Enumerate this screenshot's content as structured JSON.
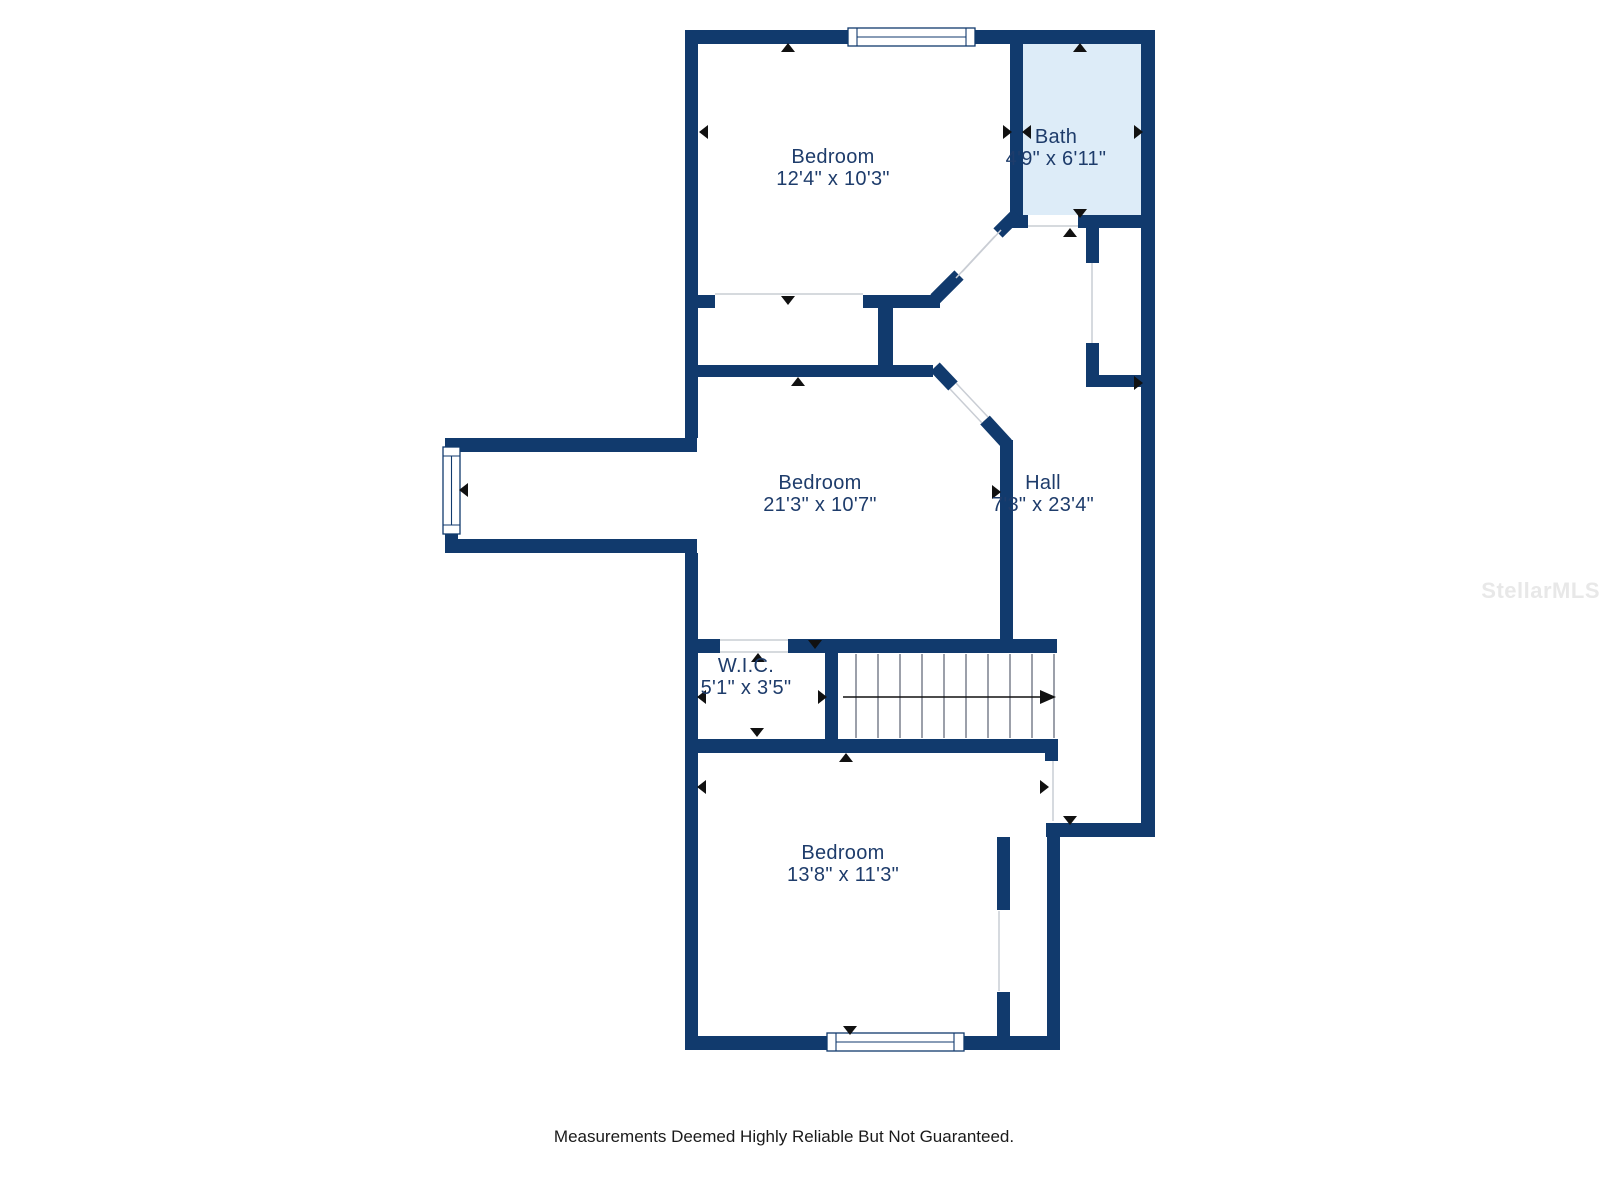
{
  "colors": {
    "background": "#ffffff",
    "wall": "#113a6d",
    "bath_fill": "#ddecf8",
    "label": "#1e3c6b",
    "opening_line": "#c9cdd4",
    "tread_line": "#5a6170",
    "arrow": "#111111",
    "footer_text": "#1a1a1a",
    "watermark": "#e8e8e8"
  },
  "rooms": [
    {
      "id": "bedroom-top",
      "name": "Bedroom",
      "dims": "12'4\" x 10'3\""
    },
    {
      "id": "bath",
      "name": "Bath",
      "dims": "4'9\" x 6'11\""
    },
    {
      "id": "bedroom-middle",
      "name": "Bedroom",
      "dims": "21'3\" x 10'7\""
    },
    {
      "id": "hall",
      "name": "Hall",
      "dims": "7'3\" x 23'4\""
    },
    {
      "id": "wic",
      "name": "W.I.C.",
      "dims": "5'1\" x 3'5\""
    },
    {
      "id": "bedroom-bottom",
      "name": "Bedroom",
      "dims": "13'8\" x 11'3\""
    }
  ],
  "footer": {
    "disclaimer": "Measurements Deemed Highly Reliable But Not Guaranteed."
  },
  "watermark": {
    "text": "StellarMLS"
  }
}
